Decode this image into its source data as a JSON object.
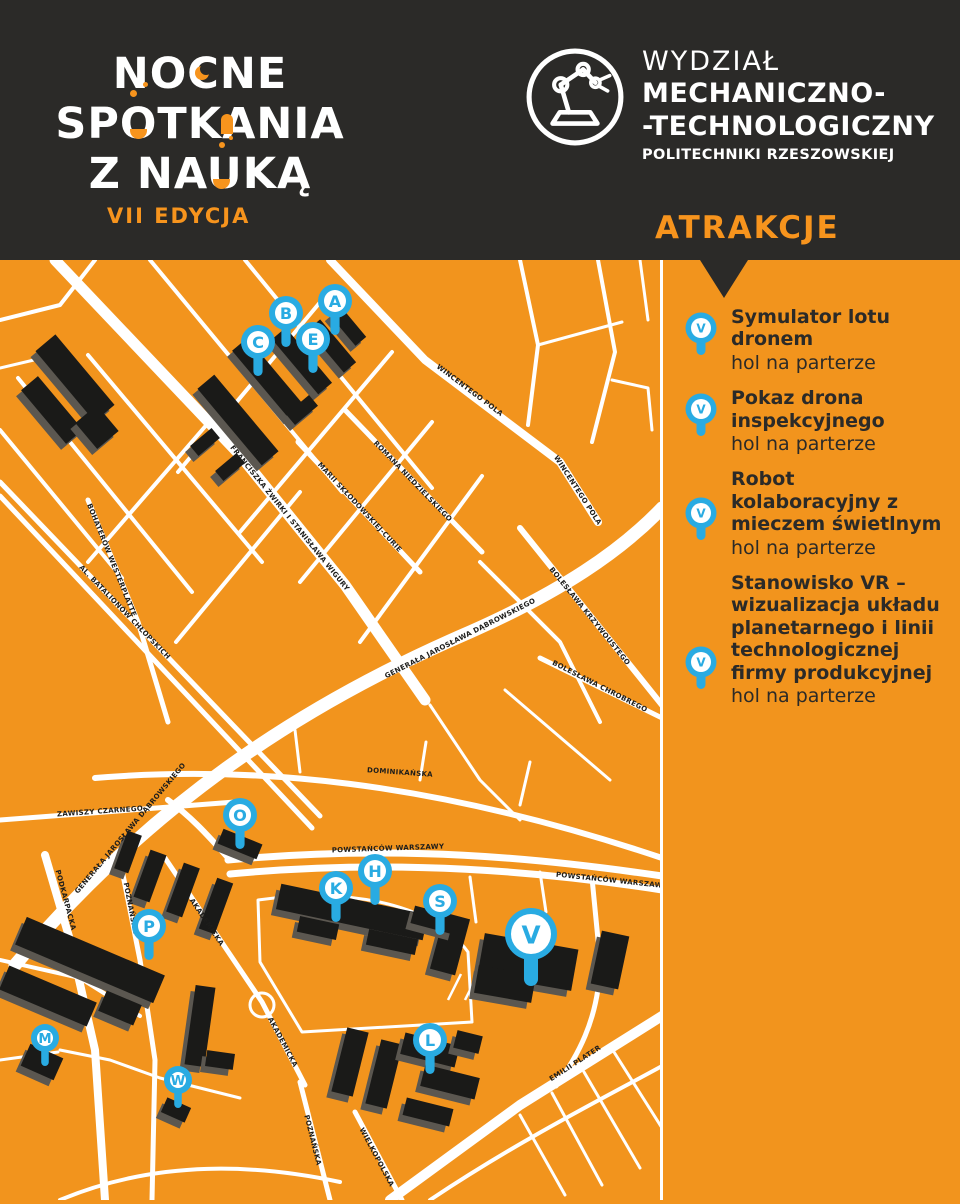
{
  "header": {
    "title_line1": "NOCNE",
    "title_line2": "SPOTKANIA",
    "title_line3": "Z NAUKĄ",
    "edition": "VII EDYCJA",
    "accent_color": "#F7941D",
    "logo": {
      "icon": "robot-arm-icon",
      "line1": "WYDZIAŁ",
      "line2": "MECHANICZNO-",
      "line3": "-TECHNOLOGICZNY",
      "line4": "POLITECHNIKI RZESZOWSKIEJ"
    }
  },
  "sidebar": {
    "heading": "ATRAKCJE",
    "items": [
      {
        "pin_letter": "V",
        "title": "Symulator lotu dronem",
        "location": "hol na parterze"
      },
      {
        "pin_letter": "V",
        "title": "Pokaz drona inspekcyjnego",
        "location": "hol na parterze"
      },
      {
        "pin_letter": "V",
        "title": "Robot kolaboracyjny z mieczem świetlnym",
        "location": "hol na parterze"
      },
      {
        "pin_letter": "V",
        "title": "Stanowisko VR – wizualizacja układu planetarnego i linii technologicznej firmy produkcyjnej",
        "location": "hol na parterze"
      }
    ]
  },
  "map": {
    "markers": [
      {
        "letter": "A",
        "x": 335,
        "y": 41,
        "size": "normal"
      },
      {
        "letter": "B",
        "x": 286,
        "y": 53,
        "size": "normal"
      },
      {
        "letter": "C",
        "x": 258,
        "y": 82,
        "size": "normal"
      },
      {
        "letter": "E",
        "x": 313,
        "y": 79,
        "size": "normal"
      },
      {
        "letter": "O",
        "x": 240,
        "y": 555,
        "size": "normal"
      },
      {
        "letter": "P",
        "x": 149,
        "y": 666,
        "size": "normal"
      },
      {
        "letter": "K",
        "x": 336,
        "y": 628,
        "size": "normal"
      },
      {
        "letter": "H",
        "x": 375,
        "y": 611,
        "size": "normal"
      },
      {
        "letter": "S",
        "x": 440,
        "y": 641,
        "size": "normal"
      },
      {
        "letter": "V",
        "x": 531,
        "y": 674,
        "size": "large"
      },
      {
        "letter": "M",
        "x": 45,
        "y": 778,
        "size": "small"
      },
      {
        "letter": "W",
        "x": 178,
        "y": 820,
        "size": "small"
      },
      {
        "letter": "L",
        "x": 430,
        "y": 780,
        "size": "normal"
      }
    ],
    "street_labels": [
      {
        "text": "FRANCISZKA ŻWIRKI I STANISŁAWA WIGURY",
        "x": 290,
        "y": 258,
        "angle": 51
      },
      {
        "text": "MARII SKŁODOWSKIEJ-CURIE",
        "x": 360,
        "y": 247,
        "angle": 47
      },
      {
        "text": "ROMANA NIEDZIELSKIEGO",
        "x": 413,
        "y": 221,
        "angle": 46
      },
      {
        "text": "WINCENTEGO POLA",
        "x": 470,
        "y": 130,
        "angle": 37
      },
      {
        "text": "WINCENTEGO POLA",
        "x": 578,
        "y": 230,
        "angle": 57
      },
      {
        "text": "BOLESŁAWA KRZYWOUSTEGO",
        "x": 590,
        "y": 356,
        "angle": 51
      },
      {
        "text": "BOLESŁAWA CHROBREGO",
        "x": 600,
        "y": 426,
        "angle": 27
      },
      {
        "text": "AL. BATALIONÓW CHŁOPSKICH",
        "x": 125,
        "y": 352,
        "angle": 46
      },
      {
        "text": "BOHATERÓW WESTERPLATTE",
        "x": 112,
        "y": 300,
        "angle": 68
      },
      {
        "text": "GENERAŁA JAROSŁAWA DĄBROWSKIEGO",
        "x": 460,
        "y": 378,
        "angle": -27
      },
      {
        "text": "GENERAŁA JAROSŁAWA DĄBROWSKIEGO",
        "x": 130,
        "y": 568,
        "angle": -50
      },
      {
        "text": "DOMINIKAŃSKA",
        "x": 400,
        "y": 512,
        "angle": 4
      },
      {
        "text": "POWSTAŃCÓW WARSZAWY",
        "x": 388,
        "y": 588,
        "angle": -2
      },
      {
        "text": "POWSTAŃCÓW WARSZAWY",
        "x": 612,
        "y": 620,
        "angle": 6
      },
      {
        "text": "ZAWISZY CZARNEGO",
        "x": 100,
        "y": 551,
        "angle": -4
      },
      {
        "text": "PODKARPACKA",
        "x": 66,
        "y": 640,
        "angle": 75
      },
      {
        "text": "POZNAŃSKA",
        "x": 131,
        "y": 648,
        "angle": 79
      },
      {
        "text": "AKADEMICKA",
        "x": 207,
        "y": 662,
        "angle": 56
      },
      {
        "text": "AKADEMICKA",
        "x": 283,
        "y": 782,
        "angle": 62
      },
      {
        "text": "POZNAŃSKA",
        "x": 313,
        "y": 880,
        "angle": 76
      },
      {
        "text": "WIELKOPOLSKA",
        "x": 377,
        "y": 897,
        "angle": 62
      },
      {
        "text": "EMILII PLATER",
        "x": 575,
        "y": 803,
        "angle": -33
      }
    ],
    "colors": {
      "background": "#F2941D",
      "road": "#FFFFFF",
      "building": "#1A1A18",
      "building_side": "#5B5750",
      "pin": "#29ABE2",
      "pin_inner": "#FFFFFF",
      "dark": "#2B2A28",
      "label": "#1D1D1B"
    }
  }
}
